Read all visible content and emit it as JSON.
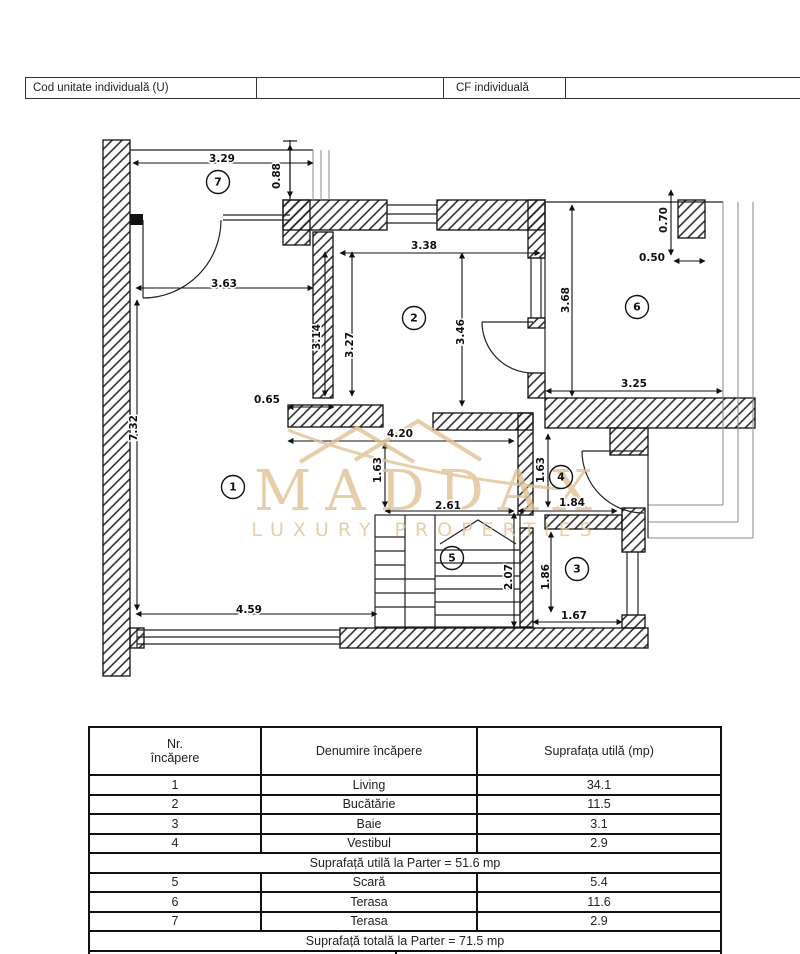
{
  "header_bar": {
    "cells": [
      {
        "label": "Cod unitate individuală (U)"
      },
      {
        "label": ""
      },
      {
        "label": "CF individuală"
      },
      {
        "label": ""
      }
    ]
  },
  "plan": {
    "watermark": {
      "brand": "MADDAX",
      "tagline": "LUXURY PROPERTIES",
      "color": "#dfc194"
    },
    "rooms": [
      {
        "num": "1",
        "x": 233,
        "y": 487
      },
      {
        "num": "2",
        "x": 414,
        "y": 318
      },
      {
        "num": "3",
        "x": 577,
        "y": 569
      },
      {
        "num": "4",
        "x": 561,
        "y": 477
      },
      {
        "num": "5",
        "x": 452,
        "y": 558
      },
      {
        "num": "6",
        "x": 637,
        "y": 307
      },
      {
        "num": "7",
        "x": 218,
        "y": 182
      }
    ],
    "dims": [
      {
        "label": "3.29",
        "x": 222,
        "y": 159,
        "v": false
      },
      {
        "label": "0.88",
        "x": 277,
        "y": 176,
        "v": true
      },
      {
        "label": "3.63",
        "x": 224,
        "y": 284,
        "v": false
      },
      {
        "label": "7.32",
        "x": 134,
        "y": 428,
        "v": true
      },
      {
        "label": "0.65",
        "x": 267,
        "y": 400,
        "v": false
      },
      {
        "label": "4.59",
        "x": 249,
        "y": 610,
        "v": false
      },
      {
        "label": "3.14",
        "x": 317,
        "y": 337,
        "v": true
      },
      {
        "label": "3.27",
        "x": 350,
        "y": 345,
        "v": true
      },
      {
        "label": "3.38",
        "x": 424,
        "y": 246,
        "v": false
      },
      {
        "label": "3.46",
        "x": 461,
        "y": 332,
        "v": true
      },
      {
        "label": "3.68",
        "x": 566,
        "y": 300,
        "v": true
      },
      {
        "label": "3.25",
        "x": 634,
        "y": 384,
        "v": false
      },
      {
        "label": "0.70",
        "x": 664,
        "y": 220,
        "v": true
      },
      {
        "label": "0.50",
        "x": 652,
        "y": 258,
        "v": false
      },
      {
        "label": "4.20",
        "x": 400,
        "y": 434,
        "v": false
      },
      {
        "label": "1.63",
        "x": 378,
        "y": 470,
        "v": true
      },
      {
        "label": "1.63",
        "x": 541,
        "y": 470,
        "v": true
      },
      {
        "label": "2.61",
        "x": 448,
        "y": 506,
        "v": false
      },
      {
        "label": "1.84",
        "x": 572,
        "y": 503,
        "v": false
      },
      {
        "label": "2.07",
        "x": 509,
        "y": 577,
        "v": true
      },
      {
        "label": "1.86",
        "x": 546,
        "y": 577,
        "v": true
      },
      {
        "label": "1.67",
        "x": 574,
        "y": 616,
        "v": false
      }
    ]
  },
  "table": {
    "header": {
      "col1a": "Nr.",
      "col1b": "încăpere",
      "col2": "Denumire încăpere",
      "col3": "Suprafața utilă (mp)"
    },
    "rows_parter": [
      [
        "1",
        "Living",
        "34.1"
      ],
      [
        "2",
        "Bucătărie",
        "11.5"
      ],
      [
        "3",
        "Baie",
        "3.1"
      ],
      [
        "4",
        "Vestibul",
        "2.9"
      ]
    ],
    "subtotal": "Suprafață utilă la Parter = 51.6 mp",
    "rows_anexe": [
      [
        "5",
        "Scară",
        "5.4"
      ],
      [
        "6",
        "Terasa",
        "11.6"
      ],
      [
        "7",
        "Terasa",
        "2.9"
      ]
    ],
    "total": "Suprafață totală la Parter = 71.5 mp"
  }
}
